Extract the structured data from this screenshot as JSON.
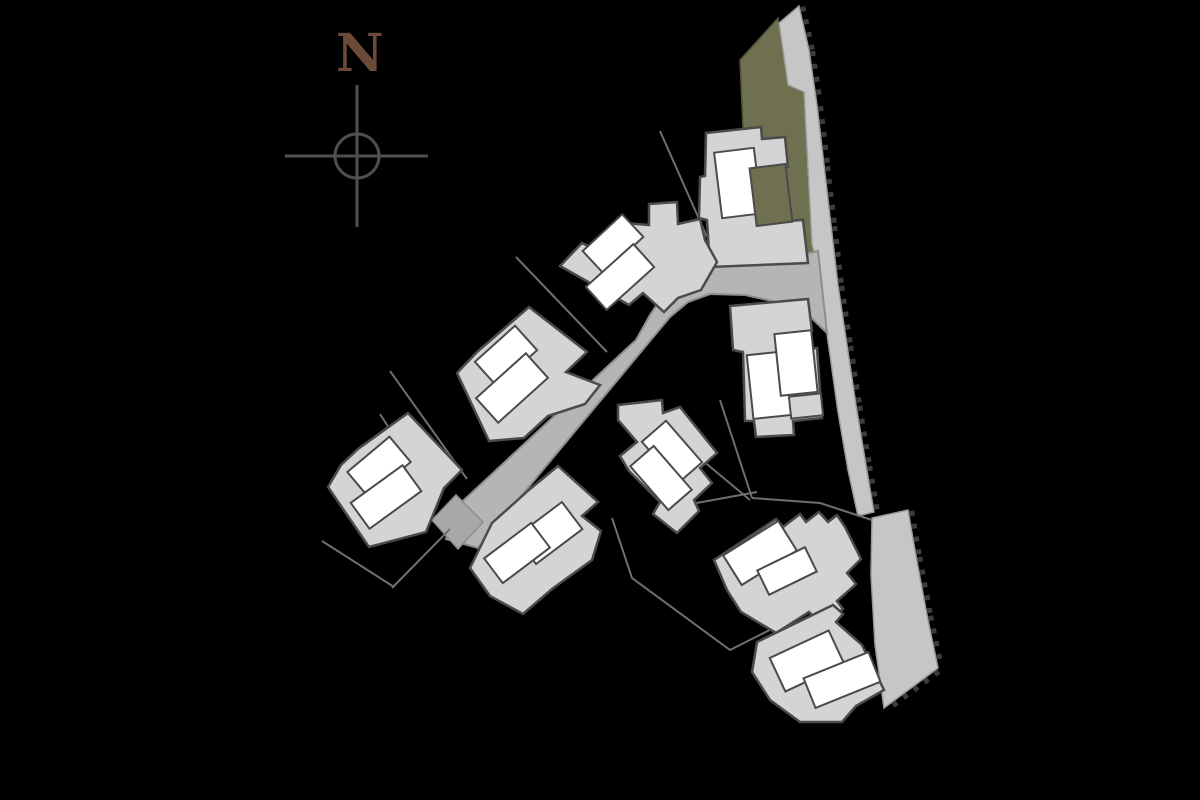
{
  "plan": {
    "type": "residential-site-plan",
    "background": "#000000"
  },
  "palette": {
    "footprint_fill": "#d4d4d4",
    "unit_fill": "#ffffff",
    "outline": "#4b4b4b",
    "road_fill": "#b5b5b5",
    "road_edge": "#8d8d8d",
    "road_end_fill": "#a8a8a8",
    "strip_fill": "#c6c6c6",
    "strip_edge": "#9a9a9a",
    "green_fill": "#6e7050",
    "green_edge": "#4f5138",
    "hatch_color": "#3c3c3c",
    "plot_line": "#6f6f6f",
    "compass_stroke": "#4f4f4f",
    "north_color": "#6b4a38"
  },
  "north": {
    "label": "N",
    "label_x": 336,
    "label_y": 71,
    "label_size": 52,
    "circle": {
      "cx": 357,
      "cy": 156,
      "r": 22
    },
    "vline": {
      "x": 357,
      "y1": 85,
      "y2": 227
    },
    "hline": {
      "y": 156,
      "x1": 285,
      "x2": 428
    },
    "stroke_width": 3
  },
  "green_area": {
    "points": [
      [
        740,
        60
      ],
      [
        778,
        18
      ],
      [
        788,
        85
      ],
      [
        804,
        92
      ],
      [
        812,
        245
      ],
      [
        818,
        262
      ],
      [
        800,
        268
      ],
      [
        748,
        266
      ],
      [
        744,
        150
      ]
    ]
  },
  "strips": {
    "upper": {
      "points": [
        [
          799,
          6
        ],
        [
          809,
          50
        ],
        [
          817,
          105
        ],
        [
          824,
          165
        ],
        [
          831,
          225
        ],
        [
          838,
          285
        ],
        [
          847,
          345
        ],
        [
          856,
          405
        ],
        [
          866,
          465
        ],
        [
          874,
          512
        ],
        [
          858,
          516
        ],
        [
          848,
          470
        ],
        [
          838,
          412
        ],
        [
          830,
          355
        ],
        [
          822,
          300
        ],
        [
          817,
          262
        ],
        [
          812,
          245
        ],
        [
          804,
          92
        ],
        [
          788,
          85
        ],
        [
          779,
          23
        ]
      ]
    },
    "lower": {
      "points": [
        [
          872,
          518
        ],
        [
          908,
          510
        ],
        [
          916,
          556
        ],
        [
          927,
          615
        ],
        [
          938,
          668
        ],
        [
          884,
          708
        ],
        [
          875,
          645
        ],
        [
          871,
          575
        ]
      ]
    }
  },
  "hatch": {
    "spacing": 13,
    "size": 5,
    "paths": [
      [
        [
          799,
          6
        ],
        [
          809,
          50
        ],
        [
          817,
          105
        ],
        [
          824,
          165
        ],
        [
          831,
          225
        ],
        [
          838,
          285
        ],
        [
          847,
          345
        ],
        [
          856,
          405
        ],
        [
          866,
          465
        ],
        [
          874,
          512
        ]
      ],
      [
        [
          908,
          510
        ],
        [
          916,
          556
        ],
        [
          927,
          615
        ],
        [
          938,
          668
        ],
        [
          884,
          708
        ]
      ]
    ]
  },
  "road": {
    "points": [
      [
        451,
        512
      ],
      [
        636,
        340
      ],
      [
        650,
        315
      ],
      [
        668,
        288
      ],
      [
        690,
        272
      ],
      [
        720,
        264
      ],
      [
        780,
        259
      ],
      [
        818,
        251
      ],
      [
        827,
        333
      ],
      [
        800,
        307
      ],
      [
        745,
        295
      ],
      [
        710,
        294
      ],
      [
        688,
        302
      ],
      [
        670,
        317
      ],
      [
        655,
        335
      ],
      [
        478,
        548
      ],
      [
        446,
        539
      ]
    ],
    "end_cap": [
      [
        432,
        520
      ],
      [
        456,
        495
      ],
      [
        483,
        522
      ],
      [
        458,
        549
      ]
    ]
  },
  "plot_lines": [
    [
      [
        390,
        371
      ],
      [
        467,
        479
      ]
    ],
    [
      [
        516,
        257
      ],
      [
        607,
        352
      ]
    ],
    [
      [
        660,
        131
      ],
      [
        707,
        237
      ]
    ],
    [
      [
        380,
        414
      ],
      [
        421,
        478
      ]
    ],
    [
      [
        322,
        541
      ],
      [
        394,
        587
      ]
    ],
    [
      [
        450,
        529
      ],
      [
        392,
        588
      ]
    ],
    [
      [
        720,
        400
      ],
      [
        752,
        498
      ]
    ],
    [
      [
        690,
        450
      ],
      [
        750,
        500
      ]
    ],
    [
      [
        612,
        518
      ],
      [
        632,
        578
      ],
      [
        730,
        650
      ],
      [
        833,
        598
      ]
    ],
    [
      [
        680,
        506
      ],
      [
        757,
        492
      ]
    ],
    [
      [
        752,
        498
      ],
      [
        820,
        503
      ],
      [
        872,
        520
      ]
    ]
  ],
  "buildings": [
    {
      "id": "building-1",
      "footprint": [
        [
          706,
          133
        ],
        [
          761,
          127
        ],
        [
          762,
          139
        ],
        [
          785,
          137
        ],
        [
          788,
          167
        ],
        [
          766,
          169
        ],
        [
          768,
          222
        ],
        [
          803,
          220
        ],
        [
          808,
          263
        ],
        [
          710,
          267
        ],
        [
          707,
          220
        ],
        [
          699,
          218
        ],
        [
          700,
          177
        ],
        [
          705,
          176
        ]
      ],
      "rects": [
        {
          "cx": 738,
          "cy": 183,
          "w": 40,
          "h": 66,
          "a": -7,
          "kind": "unit"
        },
        {
          "cx": 771,
          "cy": 195,
          "w": 36,
          "h": 58,
          "a": -7,
          "kind": "green"
        }
      ]
    },
    {
      "id": "building-2",
      "footprint": [
        [
          649,
          204
        ],
        [
          677,
          202
        ],
        [
          678,
          224
        ],
        [
          700,
          219
        ],
        [
          705,
          240
        ],
        [
          717,
          262
        ],
        [
          701,
          290
        ],
        [
          678,
          298
        ],
        [
          664,
          312
        ],
        [
          643,
          293
        ],
        [
          629,
          305
        ],
        [
          560,
          266
        ],
        [
          582,
          243
        ],
        [
          596,
          250
        ],
        [
          625,
          223
        ],
        [
          649,
          225
        ]
      ],
      "rects": [
        {
          "cx": 613,
          "cy": 244,
          "w": 54,
          "h": 31,
          "a": -43,
          "kind": "unit"
        },
        {
          "cx": 620,
          "cy": 277,
          "w": 64,
          "h": 31,
          "a": -42,
          "kind": "unit"
        }
      ]
    },
    {
      "id": "building-3",
      "footprint": [
        [
          529,
          307
        ],
        [
          587,
          352
        ],
        [
          566,
          372
        ],
        [
          600,
          385
        ],
        [
          585,
          404
        ],
        [
          548,
          416
        ],
        [
          524,
          438
        ],
        [
          489,
          441
        ],
        [
          457,
          373
        ],
        [
          477,
          352
        ]
      ],
      "rects": [
        {
          "cx": 506,
          "cy": 356,
          "w": 54,
          "h": 33,
          "a": -42,
          "kind": "unit"
        },
        {
          "cx": 512,
          "cy": 388,
          "w": 67,
          "h": 33,
          "a": -42,
          "kind": "unit"
        }
      ]
    },
    {
      "id": "building-4",
      "footprint": [
        [
          408,
          413
        ],
        [
          462,
          470
        ],
        [
          444,
          488
        ],
        [
          426,
          532
        ],
        [
          369,
          547
        ],
        [
          328,
          487
        ],
        [
          341,
          465
        ],
        [
          358,
          449
        ]
      ],
      "rects": [
        {
          "cx": 379,
          "cy": 467,
          "w": 55,
          "h": 33,
          "a": -40,
          "kind": "unit"
        },
        {
          "cx": 386,
          "cy": 497,
          "w": 64,
          "h": 32,
          "a": -36,
          "kind": "unit"
        }
      ]
    },
    {
      "id": "building-5",
      "footprint": [
        [
          558,
          466
        ],
        [
          598,
          502
        ],
        [
          582,
          516
        ],
        [
          601,
          531
        ],
        [
          592,
          560
        ],
        [
          552,
          589
        ],
        [
          523,
          614
        ],
        [
          490,
          596
        ],
        [
          470,
          568
        ],
        [
          492,
          523
        ],
        [
          530,
          489
        ]
      ],
      "rects": [
        {
          "cx": 549,
          "cy": 533,
          "w": 58,
          "h": 34,
          "a": -37,
          "kind": "unit"
        },
        {
          "cx": 517,
          "cy": 553,
          "w": 59,
          "h": 31,
          "a": -37,
          "kind": "unit"
        }
      ]
    },
    {
      "id": "building-6",
      "footprint": [
        [
          618,
          405
        ],
        [
          662,
          400
        ],
        [
          663,
          413
        ],
        [
          680,
          407
        ],
        [
          717,
          453
        ],
        [
          700,
          468
        ],
        [
          712,
          483
        ],
        [
          694,
          500
        ],
        [
          699,
          511
        ],
        [
          677,
          533
        ],
        [
          653,
          514
        ],
        [
          660,
          502
        ],
        [
          629,
          471
        ],
        [
          620,
          456
        ],
        [
          637,
          442
        ],
        [
          618,
          420
        ]
      ],
      "rects": [
        {
          "cx": 672,
          "cy": 452,
          "w": 32,
          "h": 55,
          "a": -41,
          "kind": "unit"
        },
        {
          "cx": 661,
          "cy": 478,
          "w": 31,
          "h": 58,
          "a": -41,
          "kind": "unit"
        }
      ]
    },
    {
      "id": "building-7",
      "footprint": [
        [
          730,
          306
        ],
        [
          808,
          299
        ],
        [
          812,
          331
        ],
        [
          794,
          333
        ],
        [
          796,
          350
        ],
        [
          817,
          348
        ],
        [
          822,
          418
        ],
        [
          793,
          421
        ],
        [
          794,
          435
        ],
        [
          756,
          437
        ],
        [
          754,
          421
        ],
        [
          745,
          421
        ],
        [
          743,
          352
        ],
        [
          733,
          350
        ]
      ],
      "rects": [
        {
          "cx": 770,
          "cy": 385,
          "w": 40,
          "h": 64,
          "a": -6,
          "kind": "unit"
        },
        {
          "cx": 796,
          "cy": 363,
          "w": 37,
          "h": 62,
          "a": -6,
          "kind": "unit"
        },
        {
          "cx": 806,
          "cy": 406,
          "w": 32,
          "h": 22,
          "a": -6,
          "kind": "patio"
        }
      ]
    },
    {
      "id": "building-8",
      "footprint": [
        [
          714,
          560
        ],
        [
          776,
          519
        ],
        [
          783,
          527
        ],
        [
          800,
          514
        ],
        [
          806,
          522
        ],
        [
          819,
          512
        ],
        [
          828,
          522
        ],
        [
          837,
          515
        ],
        [
          845,
          527
        ],
        [
          861,
          559
        ],
        [
          847,
          573
        ],
        [
          856,
          584
        ],
        [
          837,
          601
        ],
        [
          843,
          609
        ],
        [
          823,
          626
        ],
        [
          809,
          612
        ],
        [
          776,
          633
        ],
        [
          741,
          612
        ],
        [
          727,
          590
        ]
      ],
      "rects": [
        {
          "cx": 760,
          "cy": 553,
          "w": 65,
          "h": 35,
          "a": -32,
          "kind": "unit"
        },
        {
          "cx": 787,
          "cy": 571,
          "w": 53,
          "h": 27,
          "a": -26,
          "kind": "unit"
        }
      ]
    },
    {
      "id": "building-9",
      "footprint": [
        [
          757,
          642
        ],
        [
          833,
          605
        ],
        [
          843,
          614
        ],
        [
          836,
          622
        ],
        [
          862,
          645
        ],
        [
          884,
          690
        ],
        [
          856,
          706
        ],
        [
          842,
          722
        ],
        [
          800,
          722
        ],
        [
          770,
          700
        ],
        [
          752,
          672
        ]
      ],
      "rects": [
        {
          "cx": 807,
          "cy": 661,
          "w": 65,
          "h": 37,
          "a": -25,
          "kind": "unit"
        },
        {
          "cx": 842,
          "cy": 680,
          "w": 70,
          "h": 32,
          "a": -22,
          "kind": "unit"
        }
      ]
    }
  ]
}
